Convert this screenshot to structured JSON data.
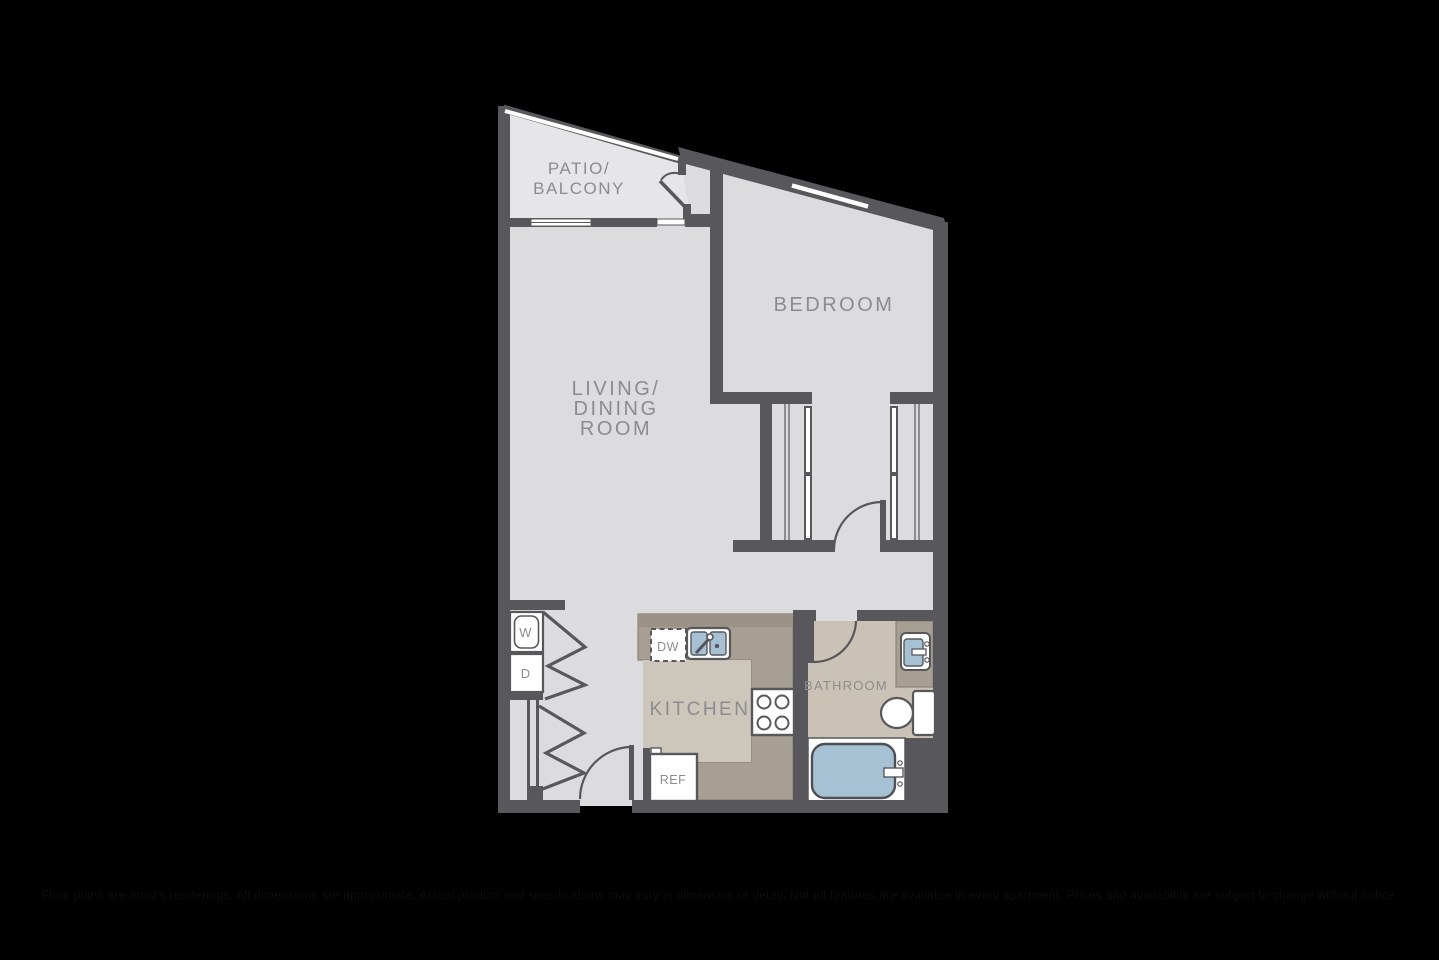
{
  "page": {
    "background_color": "#000000",
    "disclaimer": "Floor plans are artist's renderings. All dimensions are approximate. Actual product and specifications may vary in dimension or detail. Not all features are available in every apartment. Prices and availability are subject to change without notice."
  },
  "floorplan": {
    "labels": {
      "patio_line1": "PATIO/",
      "patio_line2": "BALCONY",
      "bedroom": "BEDROOM",
      "living_line1": "LIVING/",
      "living_line2": "DINING",
      "living_line3": "ROOM",
      "kitchen": "KITCHEN",
      "bathroom": "BATHROOM",
      "washer": "W",
      "dryer": "D",
      "dishwasher": "DW",
      "refrigerator": "REF"
    },
    "colors": {
      "wall": "#58585c",
      "floor_main": "#dcdcde",
      "floor_patio": "#e6e6e8",
      "floor_kitchen": "#cdc6ba",
      "floor_bathroom": "#cac3b5",
      "counter": "#a7a092",
      "counter_dark": "#9b9486",
      "fixture_blue": "#a7c1d4",
      "fixture_white": "#ffffff",
      "label_text": "#8c8c8f"
    }
  }
}
